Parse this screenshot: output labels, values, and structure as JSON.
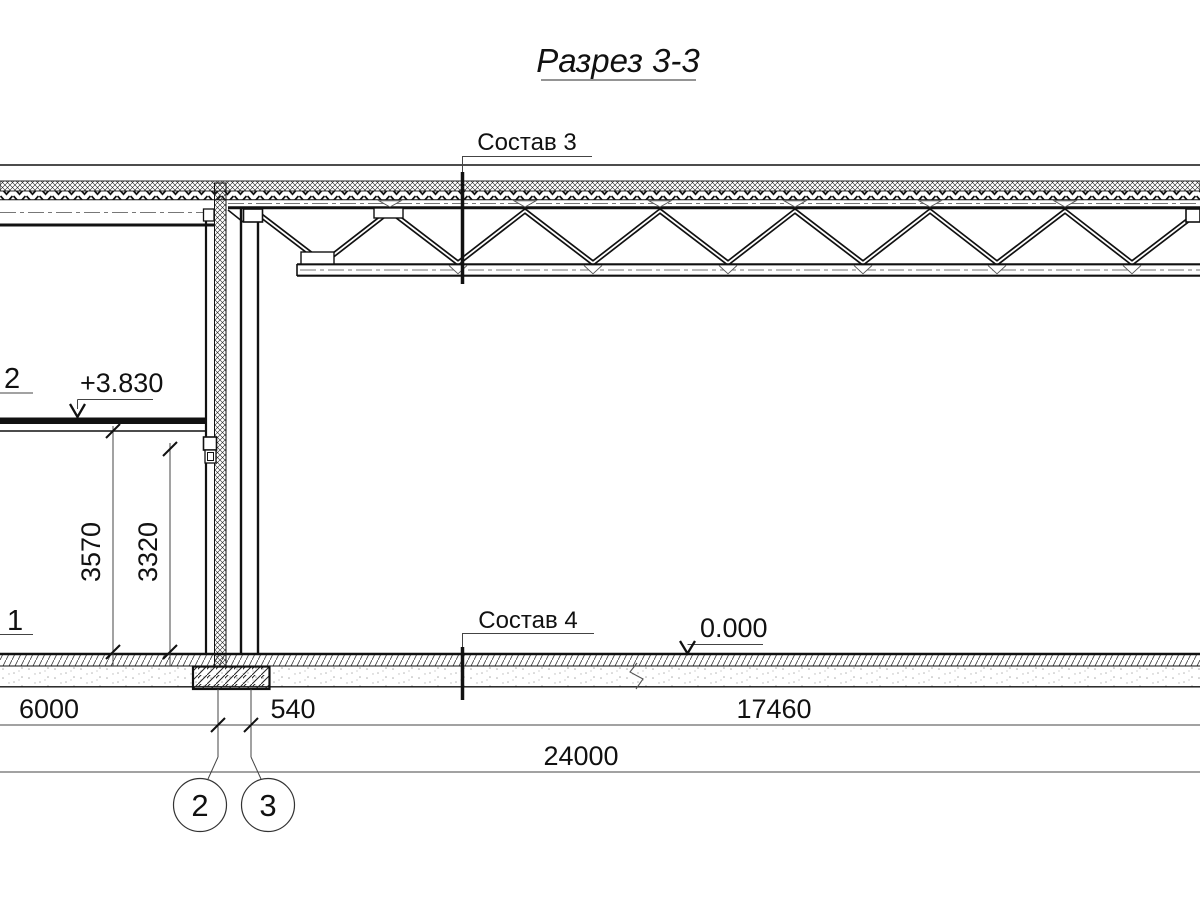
{
  "title": "Разрез 3-3",
  "section_markers": {
    "sostav3": "Состав 3",
    "sostav4": "Состав 4"
  },
  "elevations": {
    "level2": "+3.830",
    "ground": "0.000"
  },
  "position_labels": {
    "upper": "2",
    "lower": "1"
  },
  "dimensions": {
    "v_3570": "3570",
    "v_3320": "3320",
    "span_6000": "6000",
    "span_540": "540",
    "span_17460": "17460",
    "total_24000": "24000"
  },
  "axes": {
    "axis2": "2",
    "axis3": "3"
  },
  "colors": {
    "line": "#111111",
    "dim_line": "#444444",
    "centerline": "#777777",
    "background": "#ffffff"
  }
}
